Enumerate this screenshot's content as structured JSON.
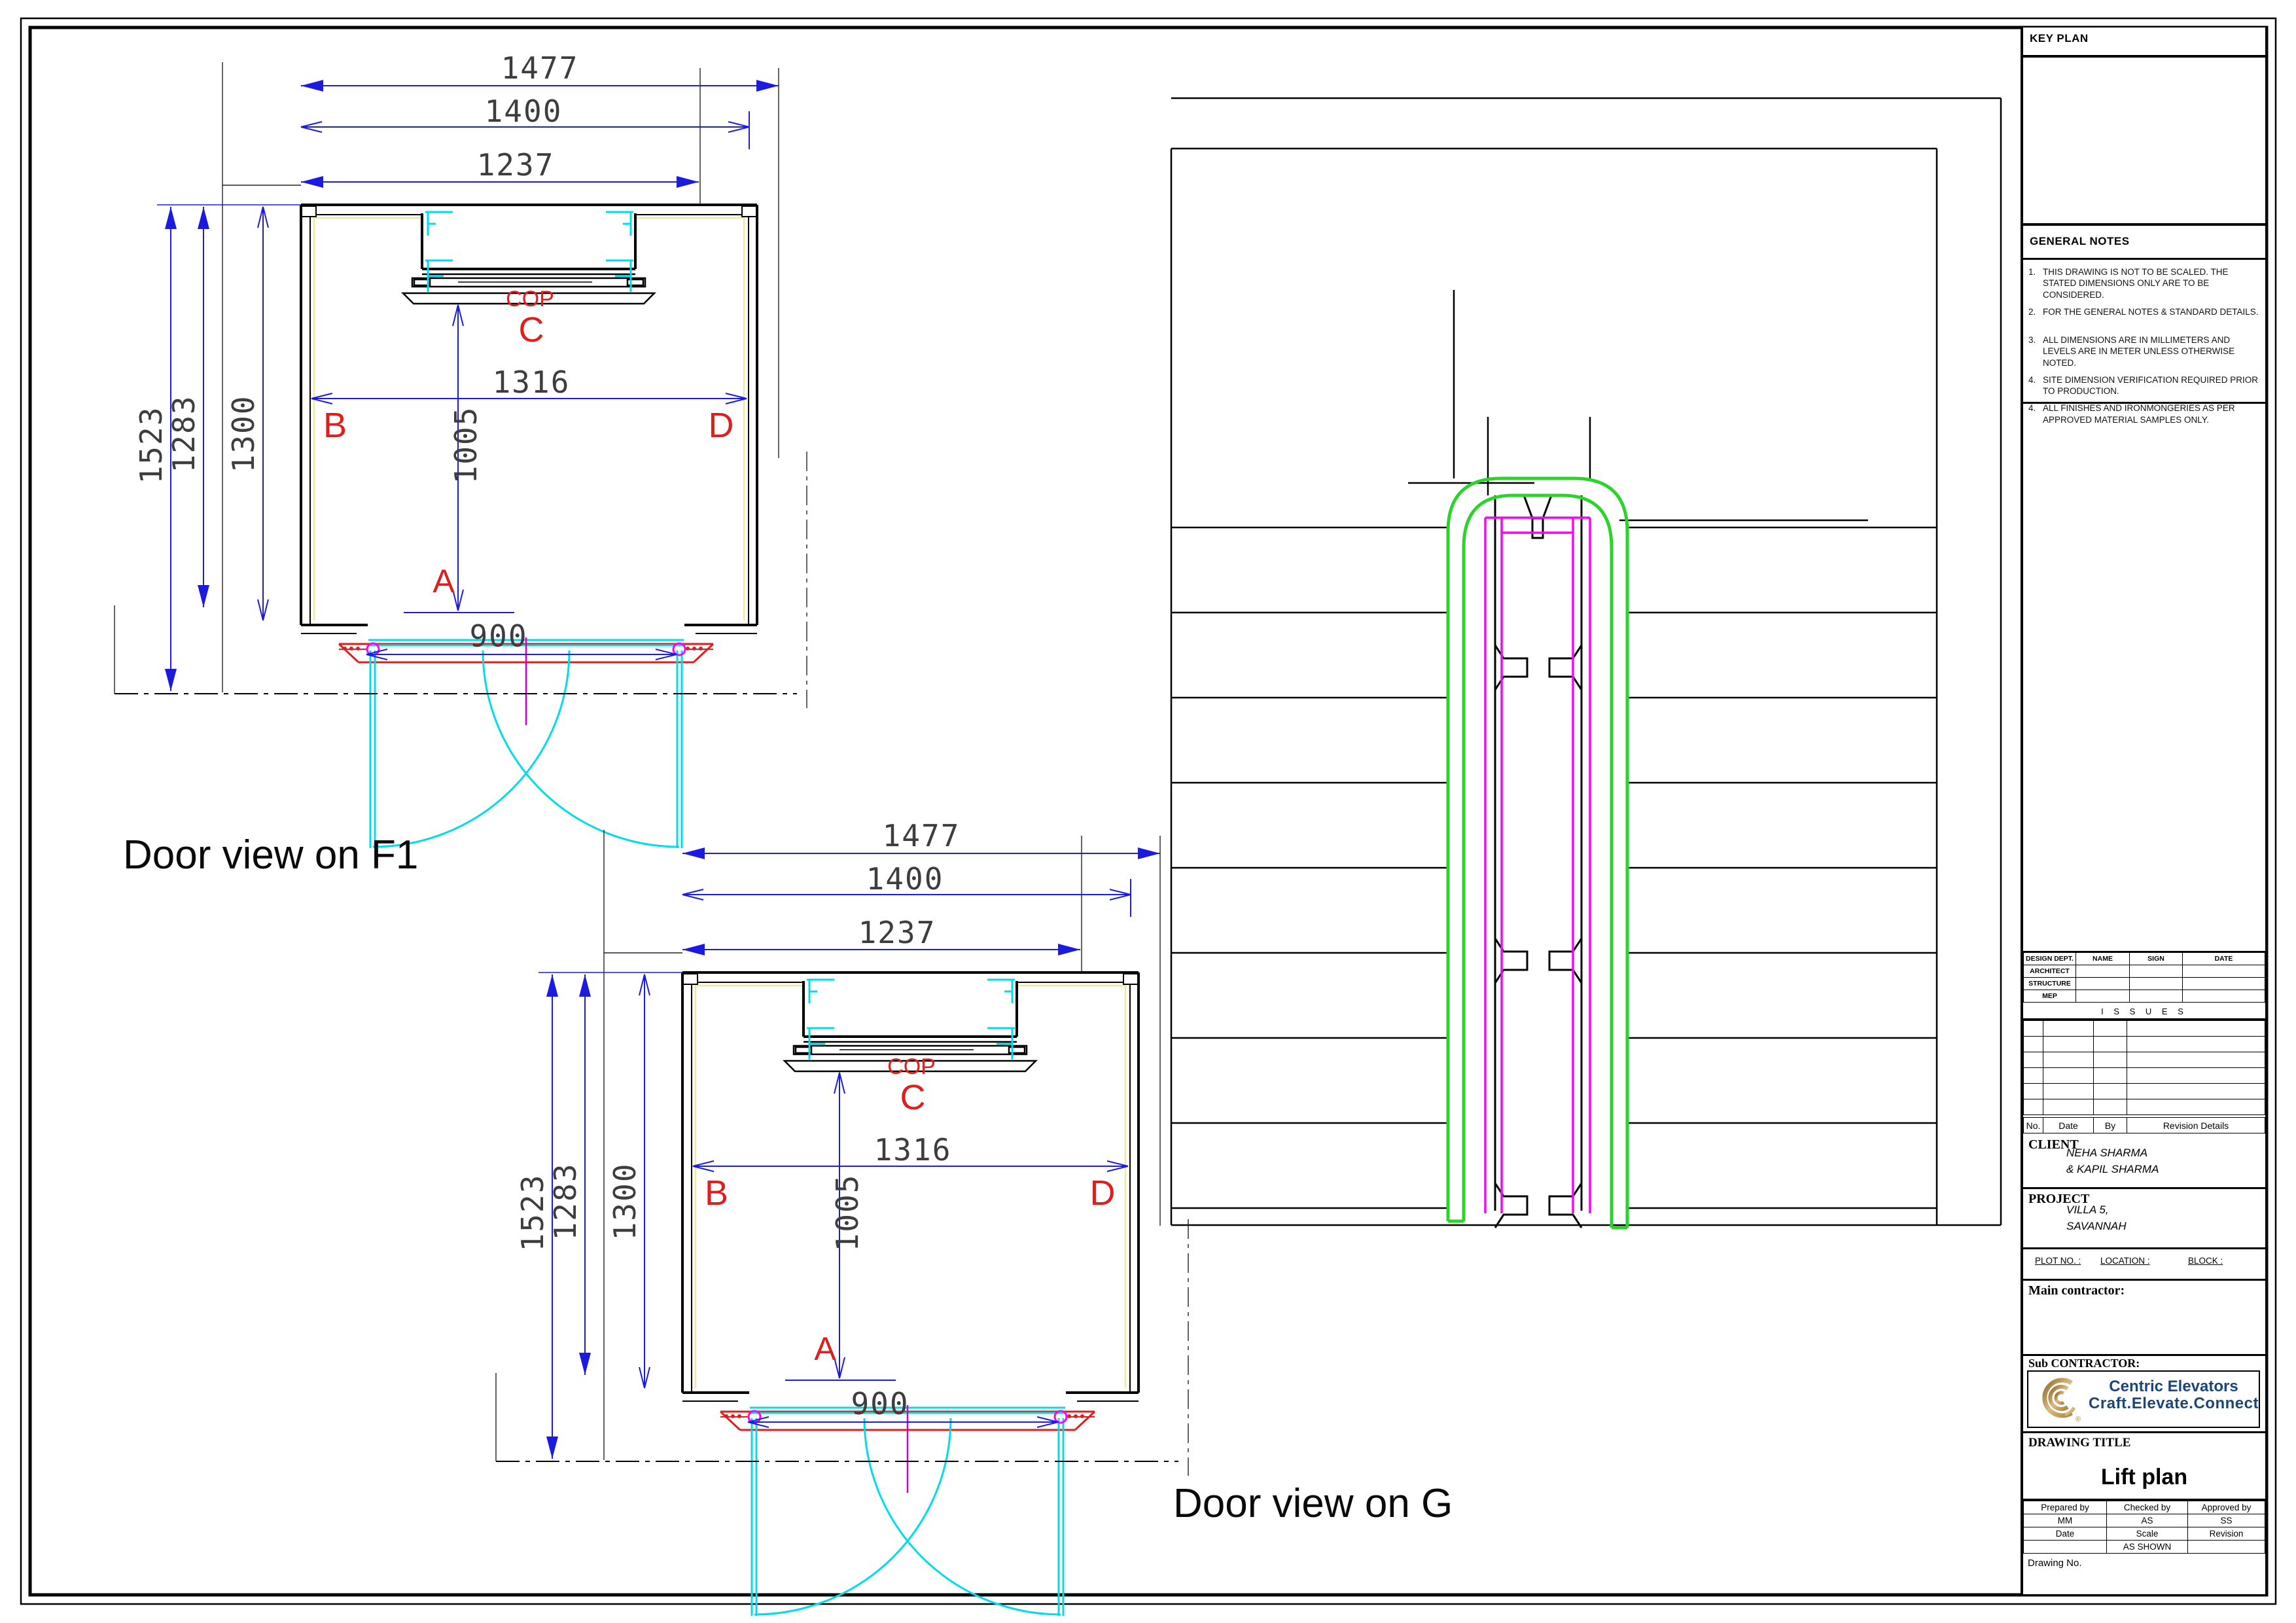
{
  "door_view": {
    "title_f1": "Door view on F1",
    "title_g": "Door view on G",
    "dims": {
      "d1477": "1477",
      "d1400": "1400",
      "d1237": "1237",
      "d1523": "1523",
      "d1283": "1283",
      "d1300": "1300",
      "d1316": "1316",
      "d1005": "1005",
      "d900": "900"
    },
    "labels": {
      "cop": "COP",
      "c": "C",
      "b": "B",
      "d": "D",
      "a": "A"
    }
  },
  "colors": {
    "dimension_blue": "#1a1ae0",
    "marker_red": "#e01e1e",
    "door_cyan": "#00dde8",
    "hinge_magenta": "#ff00ff",
    "shaft_green": "#2bd42b",
    "cab_yellow": "#eee8a2",
    "logo_gold": "#b5914c",
    "logo_navy": "#1c4677"
  },
  "title_block": {
    "key_plan": "KEY PLAN",
    "general_notes": {
      "heading": "GENERAL NOTES",
      "items": [
        {
          "n": "1.",
          "t": "THIS DRAWING IS NOT TO BE SCALED. THE STATED DIMENSIONS ONLY ARE TO BE CONSIDERED."
        },
        {
          "n": "2.",
          "t": "FOR THE GENERAL NOTES & STANDARD DETAILS."
        },
        {
          "n": "3.",
          "t": "ALL DIMENSIONS  ARE IN MILLIMETERS AND LEVELS ARE IN METER UNLESS OTHERWISE NOTED."
        },
        {
          "n": "4.",
          "t": "SITE DIMENSION VERIFICATION REQUIRED PRIOR TO PRODUCTION."
        },
        {
          "n": "4.",
          "t": "ALL FINISHES AND IRONMONGERIES AS PER APPROVED MATERIAL SAMPLES ONLY."
        }
      ]
    },
    "design_table": {
      "headers": [
        "DESIGN  DEPT.",
        "NAME",
        "SIGN",
        "DATE"
      ],
      "rows": [
        "ARCHITECT",
        "STRUCTURE",
        "MEP"
      ]
    },
    "issues_label": "I S S U E S",
    "rev_footer": {
      "no": "No.",
      "date": "Date",
      "by": "By",
      "details": "Revision Details"
    },
    "client": {
      "label": "CLIENT",
      "line1": "NEHA SHARMA",
      "line2": "& KAPIL SHARMA"
    },
    "project": {
      "label": "PROJECT",
      "line1": "VILLA 5,",
      "line2": "SAVANNAH"
    },
    "plot": {
      "plot": "PLOT NO. :",
      "location": "LOCATION :",
      "block": "BLOCK :"
    },
    "main_contractor": "Main  contractor:",
    "sub_contractor": "Sub  CONTRACTOR:",
    "logo": {
      "line1": "Centric Elevators",
      "line2": "Craft.Elevate.Connect",
      "reg": "®"
    },
    "drawing_title": {
      "label": "DRAWING  TITLE",
      "value": "Lift plan"
    },
    "sign": {
      "prepared_label": "Prepared by",
      "prepared": "MM",
      "checked_label": "Checked by",
      "checked": "AS",
      "approved_label": "Approved by",
      "approved": "SS",
      "date_label": "Date",
      "scale_label": "Scale",
      "scale": "AS  SHOWN",
      "revision_label": "Revision"
    },
    "drawing_no": "Drawing No."
  }
}
